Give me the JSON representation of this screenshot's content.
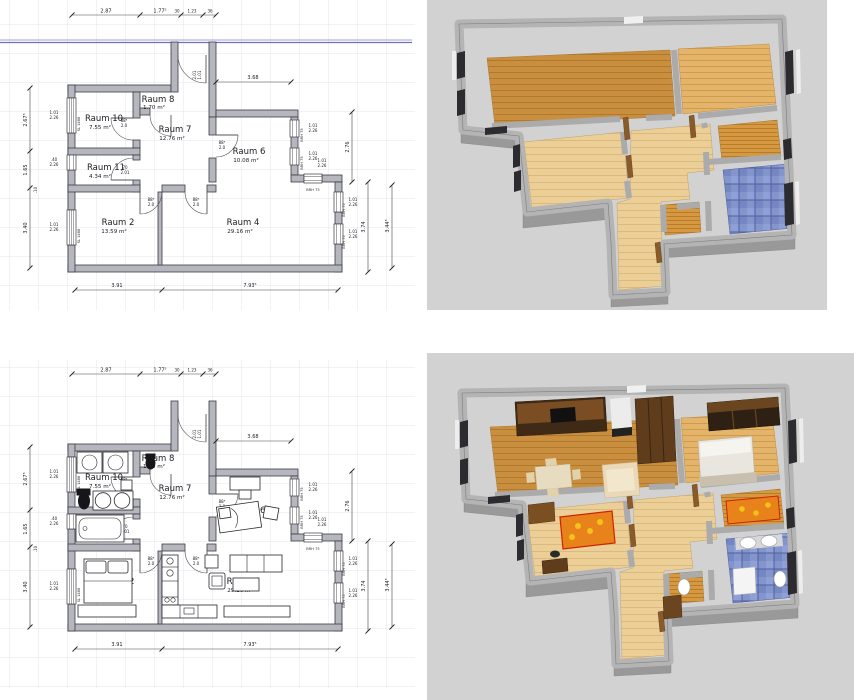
{
  "rooms": [
    {
      "name": "Raum 10",
      "area": "7.55 m²"
    },
    {
      "name": "Raum 8",
      "area": "1.70 m²"
    },
    {
      "name": "Raum 7",
      "area": "12.76 m²"
    },
    {
      "name": "Raum 6",
      "area": "10.08 m²"
    },
    {
      "name": "Raum 11",
      "area": "4.34 m²"
    },
    {
      "name": "Raum 2",
      "area": "13.59 m²"
    },
    {
      "name": "Raum 4",
      "area": "29.16 m²"
    }
  ],
  "dims": {
    "top1": "2.87",
    "top2": "1.77⁵",
    "top3": "30",
    "top4": "1.23",
    "top5": "36",
    "niche": "3.68",
    "bottom1": "3.91",
    "bottom2": "7.93⁵",
    "left1": "2.67⁵",
    "left2": "1.65",
    "left3": ".10",
    "left4": "3.40",
    "right1": "2.76",
    "right2": "3.74",
    "right3": "3.44⁵"
  },
  "openings": {
    "win_w": "1.01",
    "win_h": "2.26",
    "win_small": ".40",
    "sill_right": "BRH 75",
    "sill_left": "SL 1488",
    "door_w": "88⁵",
    "door_h": "2.0",
    "door11_w": "70",
    "door11_h": "2.01",
    "entry_w": "1.01",
    "entry_h": "2.01"
  },
  "colors": {
    "grid": "#e3e3ee",
    "wall_fill": "#b6b6bf",
    "blue_guide": "#7070c0",
    "bg_3d": "#d2d2d2",
    "wall_3d": "#b4b4b4",
    "wood_dark": "#c98f3f",
    "wood_mid": "#e3b46a",
    "wood_light": "#eccf97",
    "tile_blue": "#8495cc",
    "accent_orange": "#e8821a",
    "kitchen_brown": "#3f2a16"
  }
}
